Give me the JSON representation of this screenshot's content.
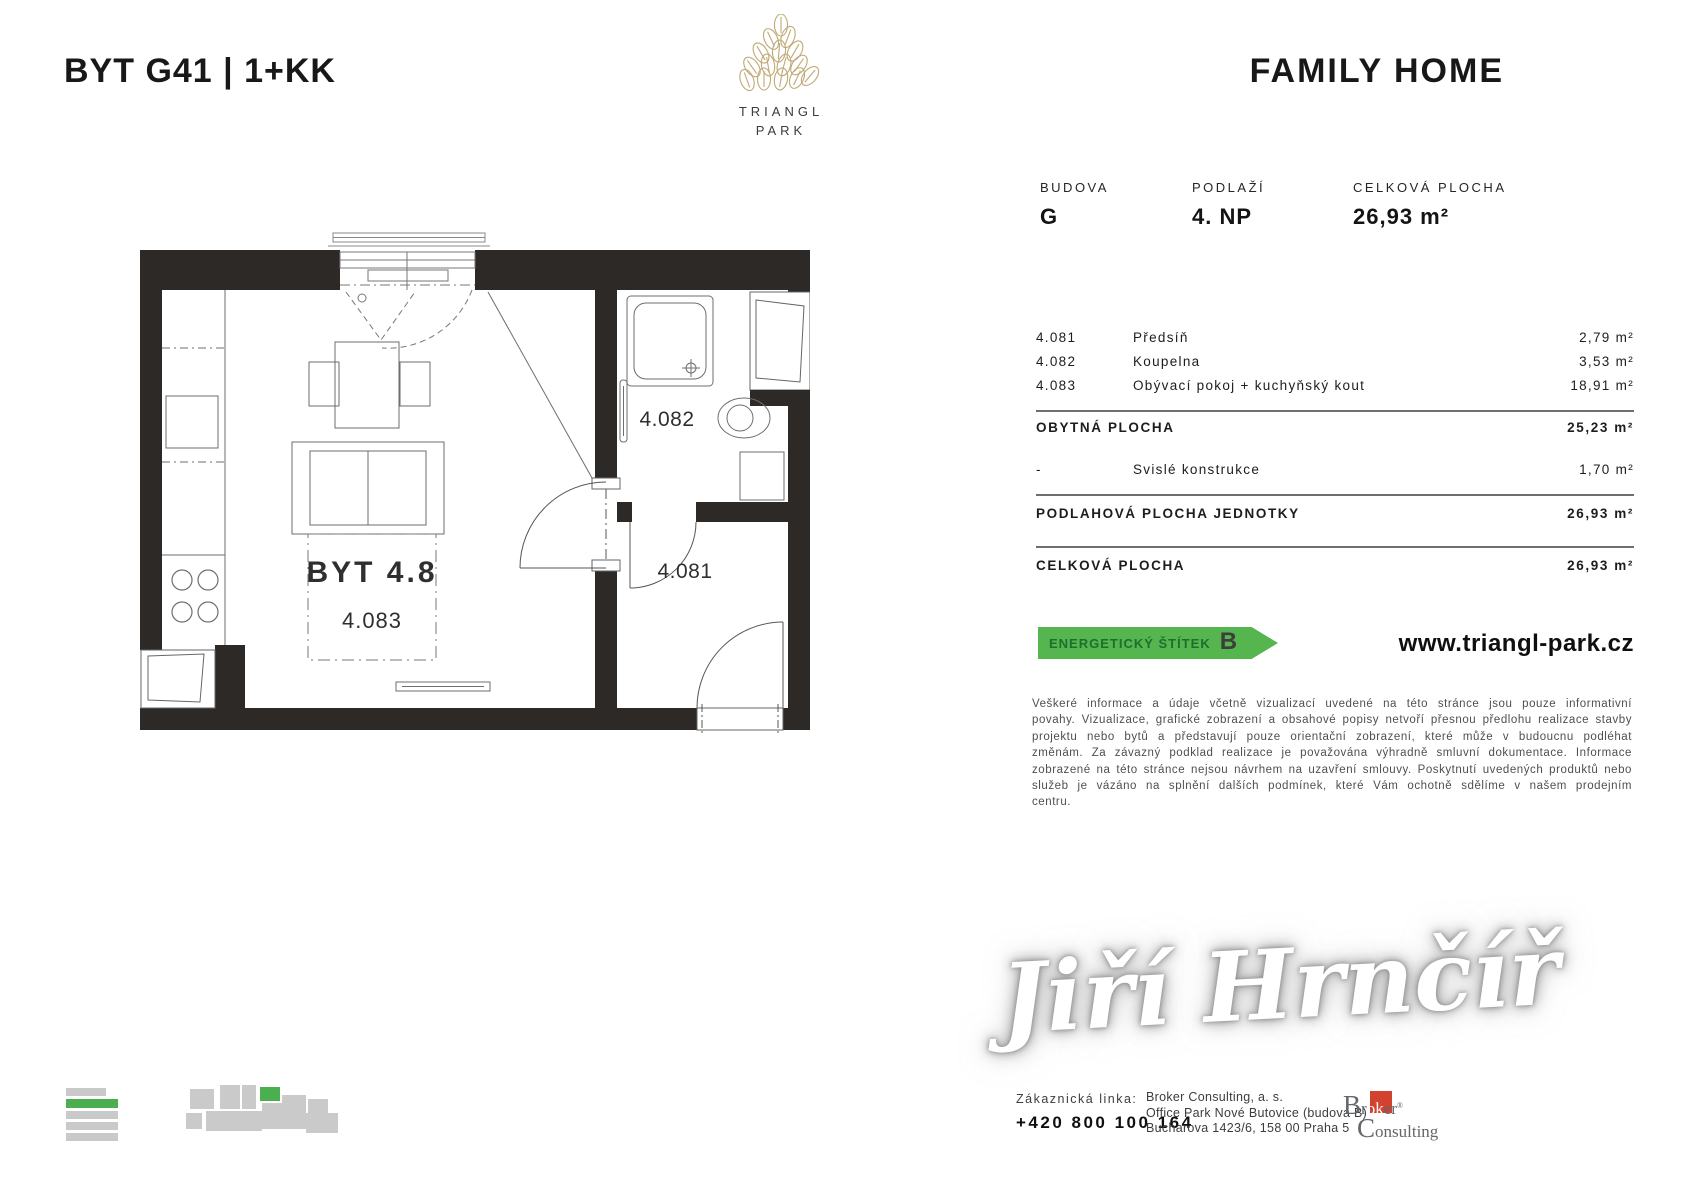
{
  "header": {
    "unit_title": "BYT G41 | 1+KK",
    "brand": "FAMILY HOME",
    "logo": {
      "line1": "TRIANGL",
      "line2": "PARK"
    }
  },
  "summary": {
    "columns": [
      {
        "label": "BUDOVA",
        "value": "G"
      },
      {
        "label": "PODLAŽÍ",
        "value": "4. NP"
      },
      {
        "label": "CELKOVÁ PLOCHA",
        "value": "26,93 m²"
      }
    ]
  },
  "rooms": [
    {
      "code": "4.081",
      "name": "Předsíň",
      "area": "2,79 m²"
    },
    {
      "code": "4.082",
      "name": "Koupelna",
      "area": "3,53 m²"
    },
    {
      "code": "4.083",
      "name": "Obývací pokoj + kuchyňský kout",
      "area": "18,91 m²"
    }
  ],
  "totals": {
    "obytna": {
      "label": "OBYTNÁ PLOCHA",
      "value": "25,23 m²"
    },
    "svisle": {
      "prefix": "-",
      "label": "Svislé konstrukce",
      "value": "1,70 m²"
    },
    "podlahova": {
      "label": "PODLAHOVÁ PLOCHA JEDNOTKY",
      "value": "26,93 m²"
    },
    "celkova": {
      "label": "CELKOVÁ PLOCHA",
      "value": "26,93 m²"
    }
  },
  "energy": {
    "label": "ENERGETICKÝ ŠTÍTEK",
    "grade": "B"
  },
  "website": "www.triangl-park.cz",
  "disclaimer": "Veškeré informace a údaje včetně vizualizací uvedené na této stránce jsou pouze informativní povahy. Vizualizace, grafické zobrazení a obsahové popisy netvoří přesnou předlohu realizace stavby projektu nebo bytů a představují pouze orientační zobrazení, které může v budoucnu podléhat změnám. Za závazný podklad realizace je považována výhradně smluvní dokumentace. Informace zobrazené na této stránce nejsou návrhem na uzavření smlouvy. Poskytnutí uvedených produktů nebo služeb je vázáno na splnění dalších podmínek, které Vám ochotně sdělíme v našem prodejním centru.",
  "signature": "Jiří Hrnčíř",
  "contact": {
    "line_label": "Zákaznická linka:",
    "phone": "+420 800 100 164",
    "company": "Broker Consulting, a. s.",
    "address1": "Office Park Nové Butovice (budova B)",
    "address2": "Bucharova 1423/6, 158 00 Praha 5"
  },
  "broker_logo": {
    "cap1": "B",
    "part1": "r",
    "highlight": "ok",
    "part2": "er",
    "reg": "®",
    "cap2": "C",
    "part3": "onsulting"
  },
  "floorplan": {
    "unit_label": "BYT 4.8",
    "living": "4.083",
    "bath": "4.082",
    "hall": "4.081"
  },
  "colors": {
    "energy_green": "#55b54f",
    "diagram_green": "#4bae4f",
    "logo_gold": "#bfa975",
    "broker_red": "#d2422f",
    "wall_dark": "#2d2926"
  }
}
